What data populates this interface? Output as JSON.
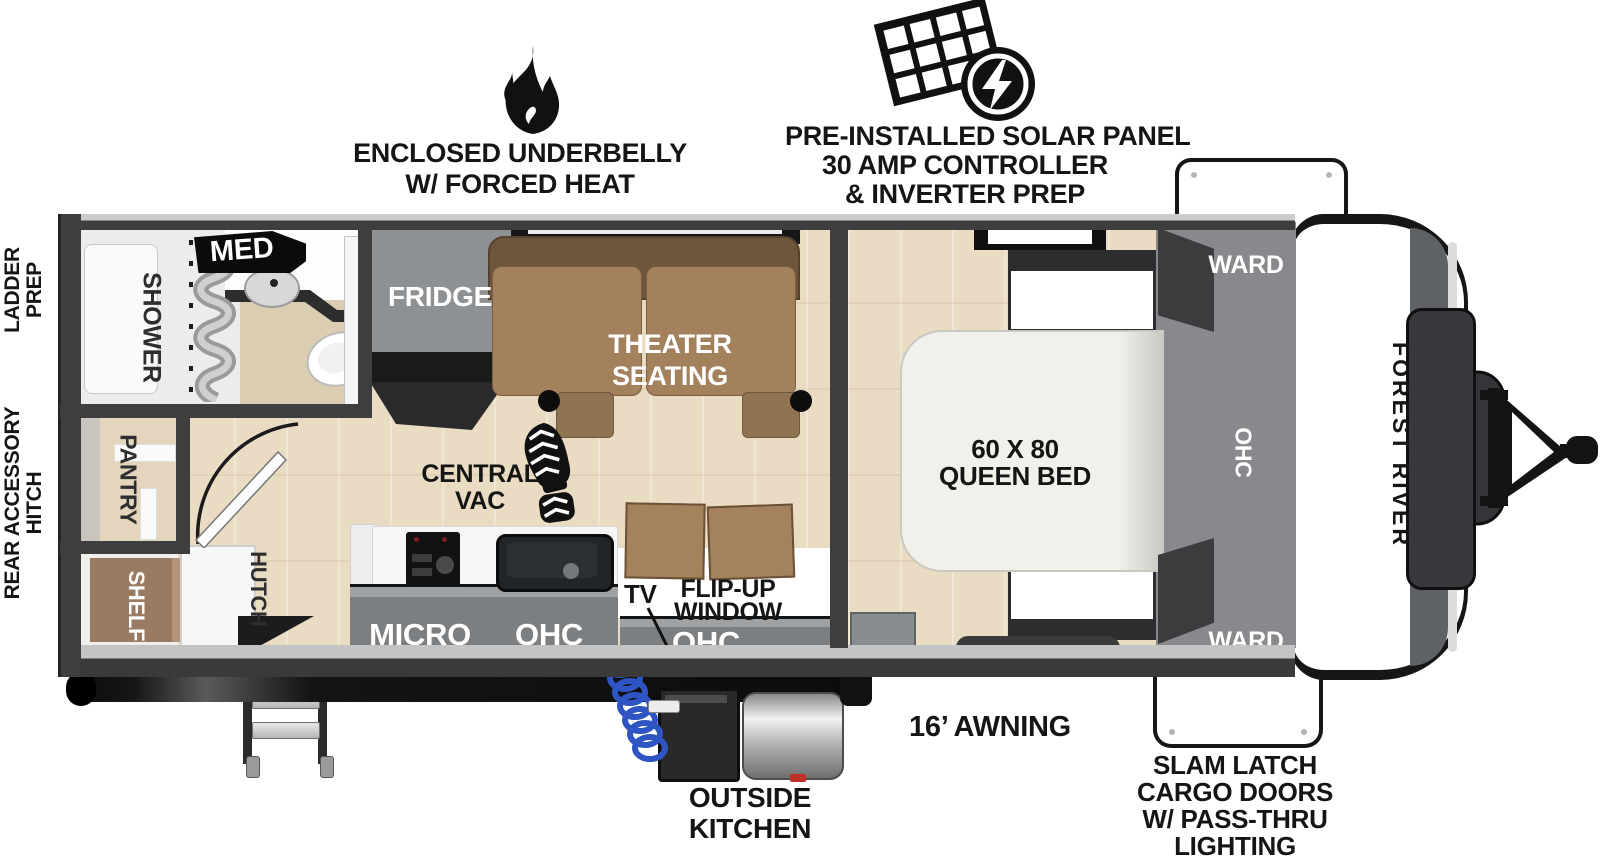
{
  "callouts": {
    "underbelly1": "ENCLOSED UNDERBELLY",
    "underbelly2": "W/ FORCED HEAT",
    "solar1": "PRE-INSTALLED SOLAR PANEL",
    "solar2": "30 AMP CONTROLLER",
    "solar3": "& INVERTER PREP",
    "ladder1": "LADDER",
    "ladder2": "PREP",
    "hitch1": "REAR ACCESSORY",
    "hitch2": "HITCH",
    "awning": "16’ AWNING",
    "outside1": "OUTSIDE",
    "outside2": "KITCHEN",
    "cargo1": "SLAM LATCH",
    "cargo2": "CARGO DOORS",
    "cargo3": "W/ PASS-THRU",
    "cargo4": "LIGHTING"
  },
  "rooms": {
    "med": "MED",
    "shower": "SHOWER",
    "pantry": "PANTRY",
    "shelf": "SHELF",
    "hutch": "HUTCH",
    "fridge": "FRIDGE",
    "theater1": "THEATER",
    "theater2": "SEATING",
    "vac1": "CENTRAL",
    "vac2": "VAC",
    "micro": "MICRO",
    "ohcKitchen": "OHC",
    "tv": "TV",
    "flip1": "FLIP-UP",
    "flip2": "WINDOW",
    "ohcEntry": "OHC",
    "bed1": "60 X 80",
    "bed2": "QUEEN BED",
    "wardTop": "WARD",
    "wardBottom": "WARD",
    "ohcBed": "OHC",
    "brand": "FOREST RIVER"
  },
  "icons": {
    "solar": "solar-panel-with-lightning-bolt",
    "underbelly": "flame",
    "centralVac": "boot-print"
  },
  "colors": {
    "wall": "#3E3E3E",
    "floorWood": "#E8DBC2",
    "counterGray": "#7C7F82",
    "sofaBrown": "#A3815C",
    "sofaBackBrown": "#6E563C",
    "applianceGray": "#8E9194",
    "shelfBrown": "#997B63",
    "bedWhite": "#F1F0EA",
    "wardrobeGray": "#87898C",
    "hoseBlue": "#2F55C4",
    "tanTile": "#DBCDB2",
    "black": "#111111"
  }
}
